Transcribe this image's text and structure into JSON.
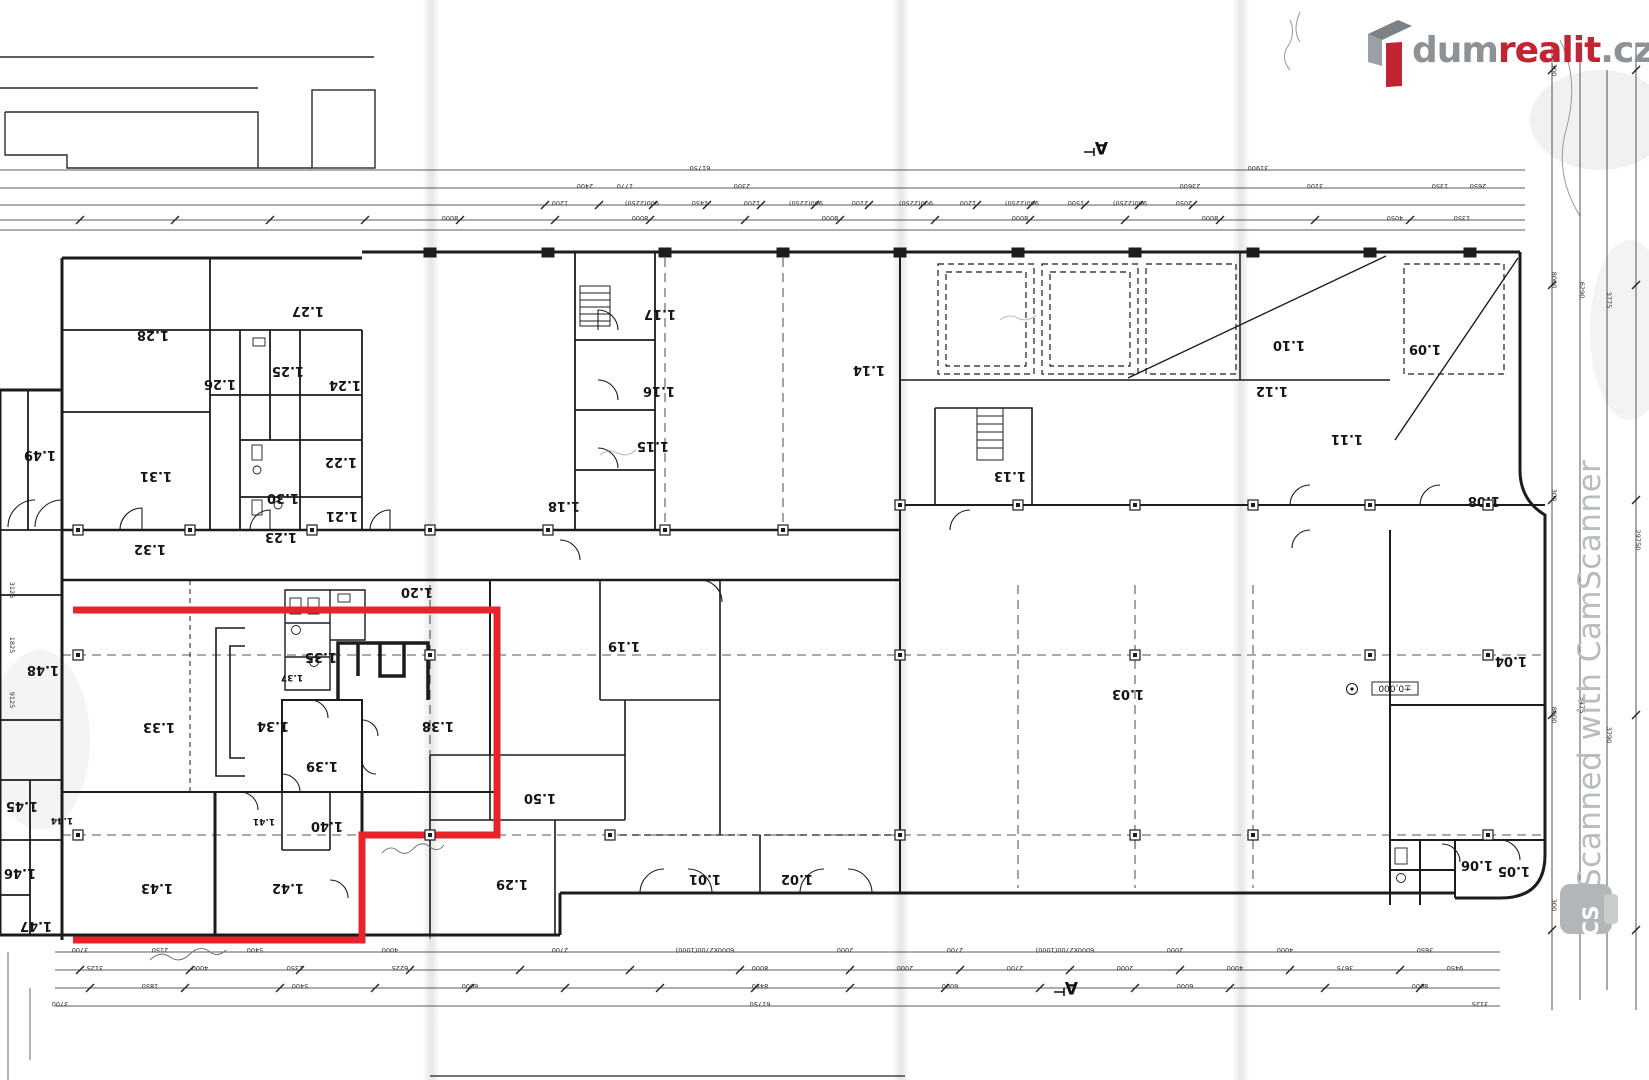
{
  "brand": {
    "name_gray": "dum",
    "name_accent": "realit",
    "tld": ".cz",
    "accent_color": "#c22532",
    "gray_color": "#8d9296"
  },
  "watermark": {
    "text": "Scanned with CamScanner",
    "badge": "CS",
    "color": "#b9bcbd"
  },
  "plan": {
    "line_color": "#1c1c1c",
    "highlight": {
      "color": "#e8242a",
      "points": "73,610 497,610 497,835 362,835 362,940 73,940"
    },
    "section_marker": "A",
    "elevation_label": "±0,000",
    "rooms": [
      {
        "id": "1.01",
        "x": 705,
        "y": 875
      },
      {
        "id": "1.02",
        "x": 797,
        "y": 875
      },
      {
        "id": "1.03",
        "x": 1128,
        "y": 690
      },
      {
        "id": "1.04",
        "x": 1511,
        "y": 657
      },
      {
        "id": "1.05",
        "x": 1514,
        "y": 867
      },
      {
        "id": "1.06",
        "x": 1477,
        "y": 861
      },
      {
        "id": "1.08",
        "x": 1484,
        "y": 497
      },
      {
        "id": "1.09",
        "x": 1425,
        "y": 345
      },
      {
        "id": "1.10",
        "x": 1289,
        "y": 341
      },
      {
        "id": "1.11",
        "x": 1347,
        "y": 435
      },
      {
        "id": "1.12",
        "x": 1272,
        "y": 387
      },
      {
        "id": "1.13",
        "x": 1010,
        "y": 472
      },
      {
        "id": "1.14",
        "x": 869,
        "y": 366
      },
      {
        "id": "1.15",
        "x": 653,
        "y": 442
      },
      {
        "id": "1.16",
        "x": 659,
        "y": 387
      },
      {
        "id": "1.17",
        "x": 660,
        "y": 310
      },
      {
        "id": "1.18",
        "x": 564,
        "y": 502
      },
      {
        "id": "1.19",
        "x": 624,
        "y": 642
      },
      {
        "id": "1.20",
        "x": 417,
        "y": 588
      },
      {
        "id": "1.21",
        "x": 342,
        "y": 512
      },
      {
        "id": "1.22",
        "x": 341,
        "y": 458
      },
      {
        "id": "1.23",
        "x": 281,
        "y": 533
      },
      {
        "id": "1.24",
        "x": 345,
        "y": 381
      },
      {
        "id": "1.25",
        "x": 288,
        "y": 367
      },
      {
        "id": "1.26",
        "x": 220,
        "y": 380
      },
      {
        "id": "1.27",
        "x": 308,
        "y": 307
      },
      {
        "id": "1.28",
        "x": 153,
        "y": 331
      },
      {
        "id": "1.29",
        "x": 512,
        "y": 880
      },
      {
        "id": "1.30",
        "x": 283,
        "y": 494
      },
      {
        "id": "1.31",
        "x": 156,
        "y": 472
      },
      {
        "id": "1.32",
        "x": 150,
        "y": 545
      },
      {
        "id": "1.33",
        "x": 159,
        "y": 723
      },
      {
        "id": "1.34",
        "x": 273,
        "y": 722
      },
      {
        "id": "1.35",
        "x": 321,
        "y": 653
      },
      {
        "id": "1.37",
        "x": 292,
        "y": 675,
        "small": true
      },
      {
        "id": "1.38",
        "x": 438,
        "y": 722
      },
      {
        "id": "1.39",
        "x": 322,
        "y": 762
      },
      {
        "id": "1.40",
        "x": 327,
        "y": 822
      },
      {
        "id": "1.41",
        "x": 264,
        "y": 819,
        "small": true
      },
      {
        "id": "1.42",
        "x": 288,
        "y": 884
      },
      {
        "id": "1.43",
        "x": 157,
        "y": 884
      },
      {
        "id": "1.44",
        "x": 62,
        "y": 818,
        "small": true
      },
      {
        "id": "1.45",
        "x": 22,
        "y": 802
      },
      {
        "id": "1.46",
        "x": 20,
        "y": 869
      },
      {
        "id": "1.47",
        "x": 36,
        "y": 922
      },
      {
        "id": "1.48",
        "x": 43,
        "y": 666
      },
      {
        "id": "1.49",
        "x": 40,
        "y": 451
      },
      {
        "id": "1.50",
        "x": 540,
        "y": 794
      }
    ],
    "grid": {
      "columns": [
        {
          "y": 530,
          "xs": [
            78,
            190,
            312,
            430,
            548,
            665,
            783
          ]
        },
        {
          "y": 505,
          "xs": [
            900,
            1018,
            1135,
            1253,
            1370,
            1488
          ]
        },
        {
          "y": 655,
          "xs": [
            78,
            430,
            900,
            1135,
            1370,
            1488
          ]
        },
        {
          "y": 835,
          "xs": [
            78,
            430,
            610,
            900,
            1135,
            1253,
            1488
          ]
        }
      ]
    },
    "dims_top": {
      "lines_y": [
        170,
        188,
        205,
        220,
        230
      ],
      "rows": [
        {
          "y": 166,
          "items": [
            [
              "61750",
              700
            ],
            [
              "31900",
              1258
            ]
          ]
        },
        {
          "y": 184,
          "items": [
            [
              "2400",
              585
            ],
            [
              "1770",
              625
            ],
            [
              "2300",
              742
            ],
            [
              "23600",
              1190
            ],
            [
              "3100",
              1315
            ],
            [
              "1350",
              1440
            ],
            [
              "2650",
              1478
            ]
          ]
        },
        {
          "y": 201,
          "items": [
            [
              "1200",
              560
            ],
            [
              "900(2250)",
              642
            ],
            [
              "1450",
              700
            ],
            [
              "1200",
              752
            ],
            [
              "900(2250)",
              806
            ],
            [
              "2100",
              860
            ],
            [
              "900(2250)",
              916
            ],
            [
              "1200",
              968
            ],
            [
              "900(2250)",
              1022
            ],
            [
              "1500",
              1076
            ],
            [
              "900(2250)",
              1130
            ],
            [
              "2050",
              1184
            ]
          ]
        },
        {
          "y": 216,
          "items": [
            [
              "8000",
              450
            ],
            [
              "8000",
              640
            ],
            [
              "8000",
              830
            ],
            [
              "8000",
              1020
            ],
            [
              "8000",
              1210
            ],
            [
              "4050",
              1395
            ],
            [
              "1350",
              1462
            ]
          ]
        }
      ]
    },
    "dims_bottom": {
      "lines_y": [
        952,
        970,
        988,
        1006
      ],
      "rows": [
        {
          "y": 948,
          "items": [
            [
              "3700",
              80
            ],
            [
              "2150",
              160
            ],
            [
              "5400",
              255
            ],
            [
              "4000",
              390
            ],
            [
              "2700",
              560
            ],
            [
              "6000x2700(1000)",
              705
            ],
            [
              "2000",
              845
            ],
            [
              "2700",
              955
            ],
            [
              "6000x2700(1000)",
              1065
            ],
            [
              "2000",
              1175
            ],
            [
              "4000",
              1285
            ],
            [
              "3650",
              1425
            ]
          ]
        },
        {
          "y": 966,
          "items": [
            [
              "3125",
              95
            ],
            [
              "4000",
              200
            ],
            [
              "1350",
              295
            ],
            [
              "6225",
              400
            ],
            [
              "8000",
              760
            ],
            [
              "2000",
              905
            ],
            [
              "2700",
              1015
            ],
            [
              "2000",
              1125
            ],
            [
              "4000",
              1235
            ],
            [
              "3675",
              1345
            ],
            [
              "9450",
              1455
            ]
          ]
        },
        {
          "y": 984,
          "items": [
            [
              "1850",
              150
            ],
            [
              "5400",
              300
            ],
            [
              "6000",
              470
            ],
            [
              "8450",
              760
            ],
            [
              "6000",
              950
            ],
            [
              "6000",
              1185
            ],
            [
              "8000",
              1420
            ]
          ]
        },
        {
          "y": 1002,
          "items": [
            [
              "61750",
              760
            ],
            [
              "3700",
              60
            ],
            [
              "3125",
              1480
            ]
          ]
        }
      ]
    },
    "dims_right": {
      "items": [
        [
          "300",
          1552,
          70
        ],
        [
          "8000",
          1552,
          280
        ],
        [
          "6290",
          1580,
          290
        ],
        [
          "3775",
          1607,
          300
        ],
        [
          "300",
          1552,
          495
        ],
        [
          "8000",
          1552,
          715
        ],
        [
          "5475",
          1580,
          705
        ],
        [
          "3790",
          1607,
          735
        ],
        [
          "29750",
          1636,
          540
        ],
        [
          "300",
          1552,
          905
        ]
      ]
    },
    "dims_left": {
      "items": [
        [
          "3125",
          10,
          590
        ],
        [
          "1825",
          10,
          645
        ],
        [
          "9125",
          10,
          700
        ]
      ]
    }
  }
}
